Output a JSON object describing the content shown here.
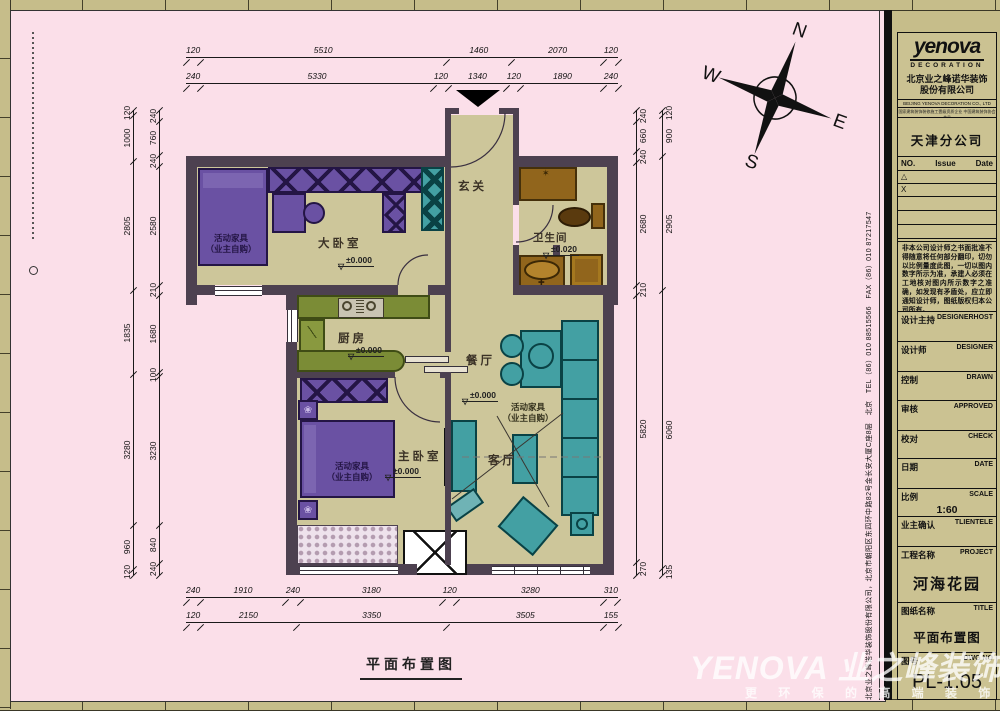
{
  "sheet": {
    "plan_caption": "平面布置图",
    "entry_arrow": "entry-arrow"
  },
  "compass": {
    "n": "N",
    "e": "E",
    "s": "S",
    "w": "W"
  },
  "rooms": {
    "entry": {
      "label": "玄关"
    },
    "big_bedroom": {
      "label": "大卧室",
      "elevation": "±0.000"
    },
    "bathroom": {
      "label": "卫生间",
      "elevation": "±0.020"
    },
    "kitchen": {
      "label": "厨房",
      "elevation": "±0.000"
    },
    "dining": {
      "label": "餐厅",
      "elevation": "±0.000"
    },
    "master_bedroom": {
      "label": "主卧室",
      "elevation": "±0.000"
    },
    "living": {
      "label": "客厅"
    }
  },
  "furniture_note": {
    "line1": "活动家具",
    "line2": "（业主自购）"
  },
  "dims": {
    "top_outer": [
      "120",
      "5510",
      "1460",
      "2070",
      "120"
    ],
    "top_inner": [
      "240",
      "5330",
      "120",
      "1340",
      "120",
      "1890",
      "240"
    ],
    "left_outer": [
      "120",
      "1000",
      "2805",
      "1835",
      "3280",
      "960",
      "120"
    ],
    "left_inner": [
      "240",
      "760",
      "240",
      "2580",
      "210",
      "1680",
      "100",
      "3230",
      "840",
      "240"
    ],
    "right_inner": [
      "240",
      "660",
      "240",
      "2680",
      "210",
      "5820",
      "270"
    ],
    "right_outer": [
      "120",
      "900",
      "2905",
      "6060",
      "135"
    ],
    "bottom_inner": [
      "240",
      "1910",
      "240",
      "3180",
      "120",
      "3280",
      "310"
    ],
    "bottom_outer": [
      "120",
      "2150",
      "3350",
      "3505",
      "155"
    ]
  },
  "titleblock": {
    "logo_text": "yenova",
    "logo_sub": "DECORATION",
    "company_cn_1": "北京业之峰诺华装饰",
    "company_cn_2": "股份有限公司",
    "company_en": "BEIJING YENOVA DECORATION CO., LTD",
    "company_cert": "国家建筑装饰装修施工壹级资质企业 中国建筑装饰协会会员",
    "branch": "天津分公司",
    "rev_no": "NO.",
    "rev_issue": "Issue",
    "rev_date": "Date",
    "rev_row1": "△",
    "rev_row2": "X",
    "disclaimer": "非本公司设计师之书面批准不得随意将任何部分翻印，切勿以比例量度此图，一切以图内数字所示为准，承建人必须在工地核对图内所示数字之准确，如发现有矛盾处，应立即通知设计师，图纸版权归本公司所有。",
    "fields": {
      "design_host": {
        "cn": "设计主持",
        "en": "DESIGNERHOST"
      },
      "designer": {
        "cn": "设计师",
        "en": "DESIGNER"
      },
      "drawn": {
        "cn": "控制",
        "en": "DRAWN"
      },
      "approved": {
        "cn": "审核",
        "en": "APPROVED"
      },
      "check": {
        "cn": "校对",
        "en": "CHECK"
      },
      "date": {
        "cn": "日期",
        "en": "DATE"
      },
      "scale": {
        "cn": "比例",
        "en": "SCALE",
        "value": "1:60"
      },
      "client": {
        "cn": "业主确认",
        "en": "TLIENTELE"
      },
      "project": {
        "cn": "工程名称",
        "en": "PROJECT",
        "value": "河海花园"
      },
      "title": {
        "cn": "图纸名称",
        "en": "TITLE",
        "value": "平面布置图"
      },
      "dwg_no": {
        "cn": "图号",
        "en": "DWG NO",
        "value": "PL-1.05"
      }
    },
    "side_text": "北京业之峰诺华装饰股份有限公司，北京市朝阳区东四环中路82号金长安大厦C座8层　北京　TEL（86）010 88515566　FAX（86）010 87217547"
  },
  "watermark": {
    "brand": "YENOVA 业之峰装饰",
    "slogan": "更 环 保 的 高 端 装 饰"
  }
}
